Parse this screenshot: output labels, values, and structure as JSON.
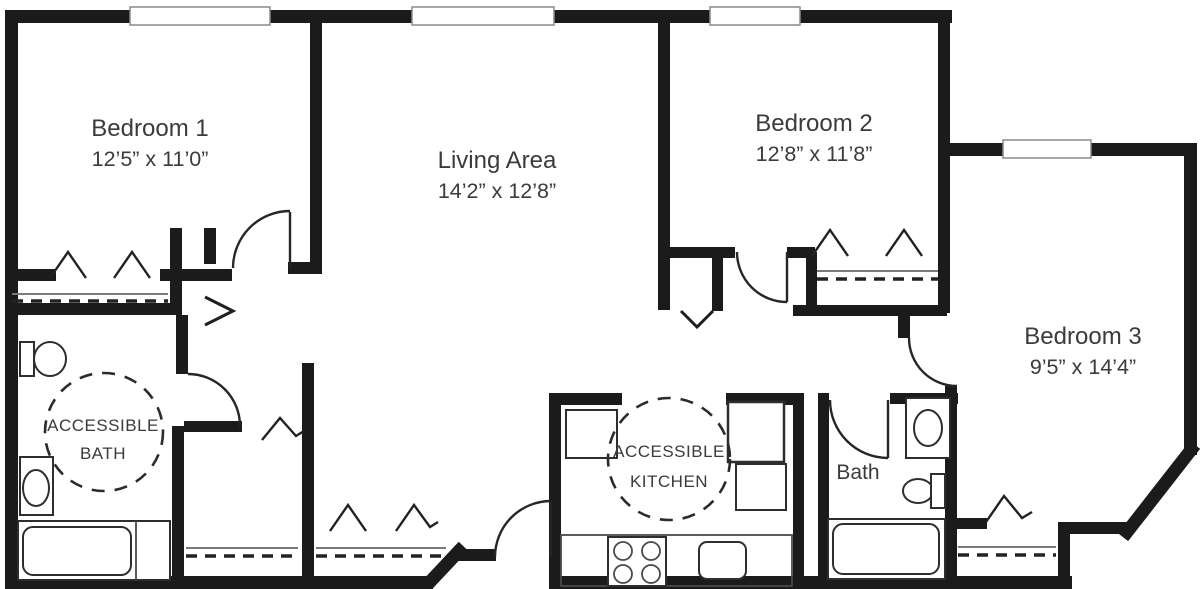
{
  "title": "Three-bedroom accessible apartment floor plan",
  "colors": {
    "background": "#ffffff",
    "wall": "#1b1b1b",
    "line": "#262626",
    "text": "#3b3b3b"
  },
  "labels": {
    "bedroom1_name": "Bedroom 1",
    "bedroom1_dims": "12’5” x 11’0”",
    "living_name": "Living Area",
    "living_dims": "14’2” x 12’8”",
    "bedroom2_name": "Bedroom 2",
    "bedroom2_dims": "12’8” x 11’8”",
    "bedroom3_name": "Bedroom 3",
    "bedroom3_dims": "9’5” x 14’4”",
    "accessible_bath_line1": "ACCESSIBLE",
    "accessible_bath_line2": "BATH",
    "accessible_kitchen_line1": "ACCESSIBLE",
    "accessible_kitchen_line2": "KITCHEN",
    "bath": "Bath"
  },
  "fixtures": {
    "accessible_bath": [
      "toilet",
      "sink-vanity",
      "bathtub",
      "turning-circle"
    ],
    "bath": [
      "sink-vanity",
      "toilet",
      "bathtub"
    ],
    "accessible_kitchen": [
      "range-stove",
      "kitchen-sink",
      "refrigerator",
      "counter",
      "turning-circle"
    ]
  },
  "windows_count": 4,
  "closets_count": 5
}
